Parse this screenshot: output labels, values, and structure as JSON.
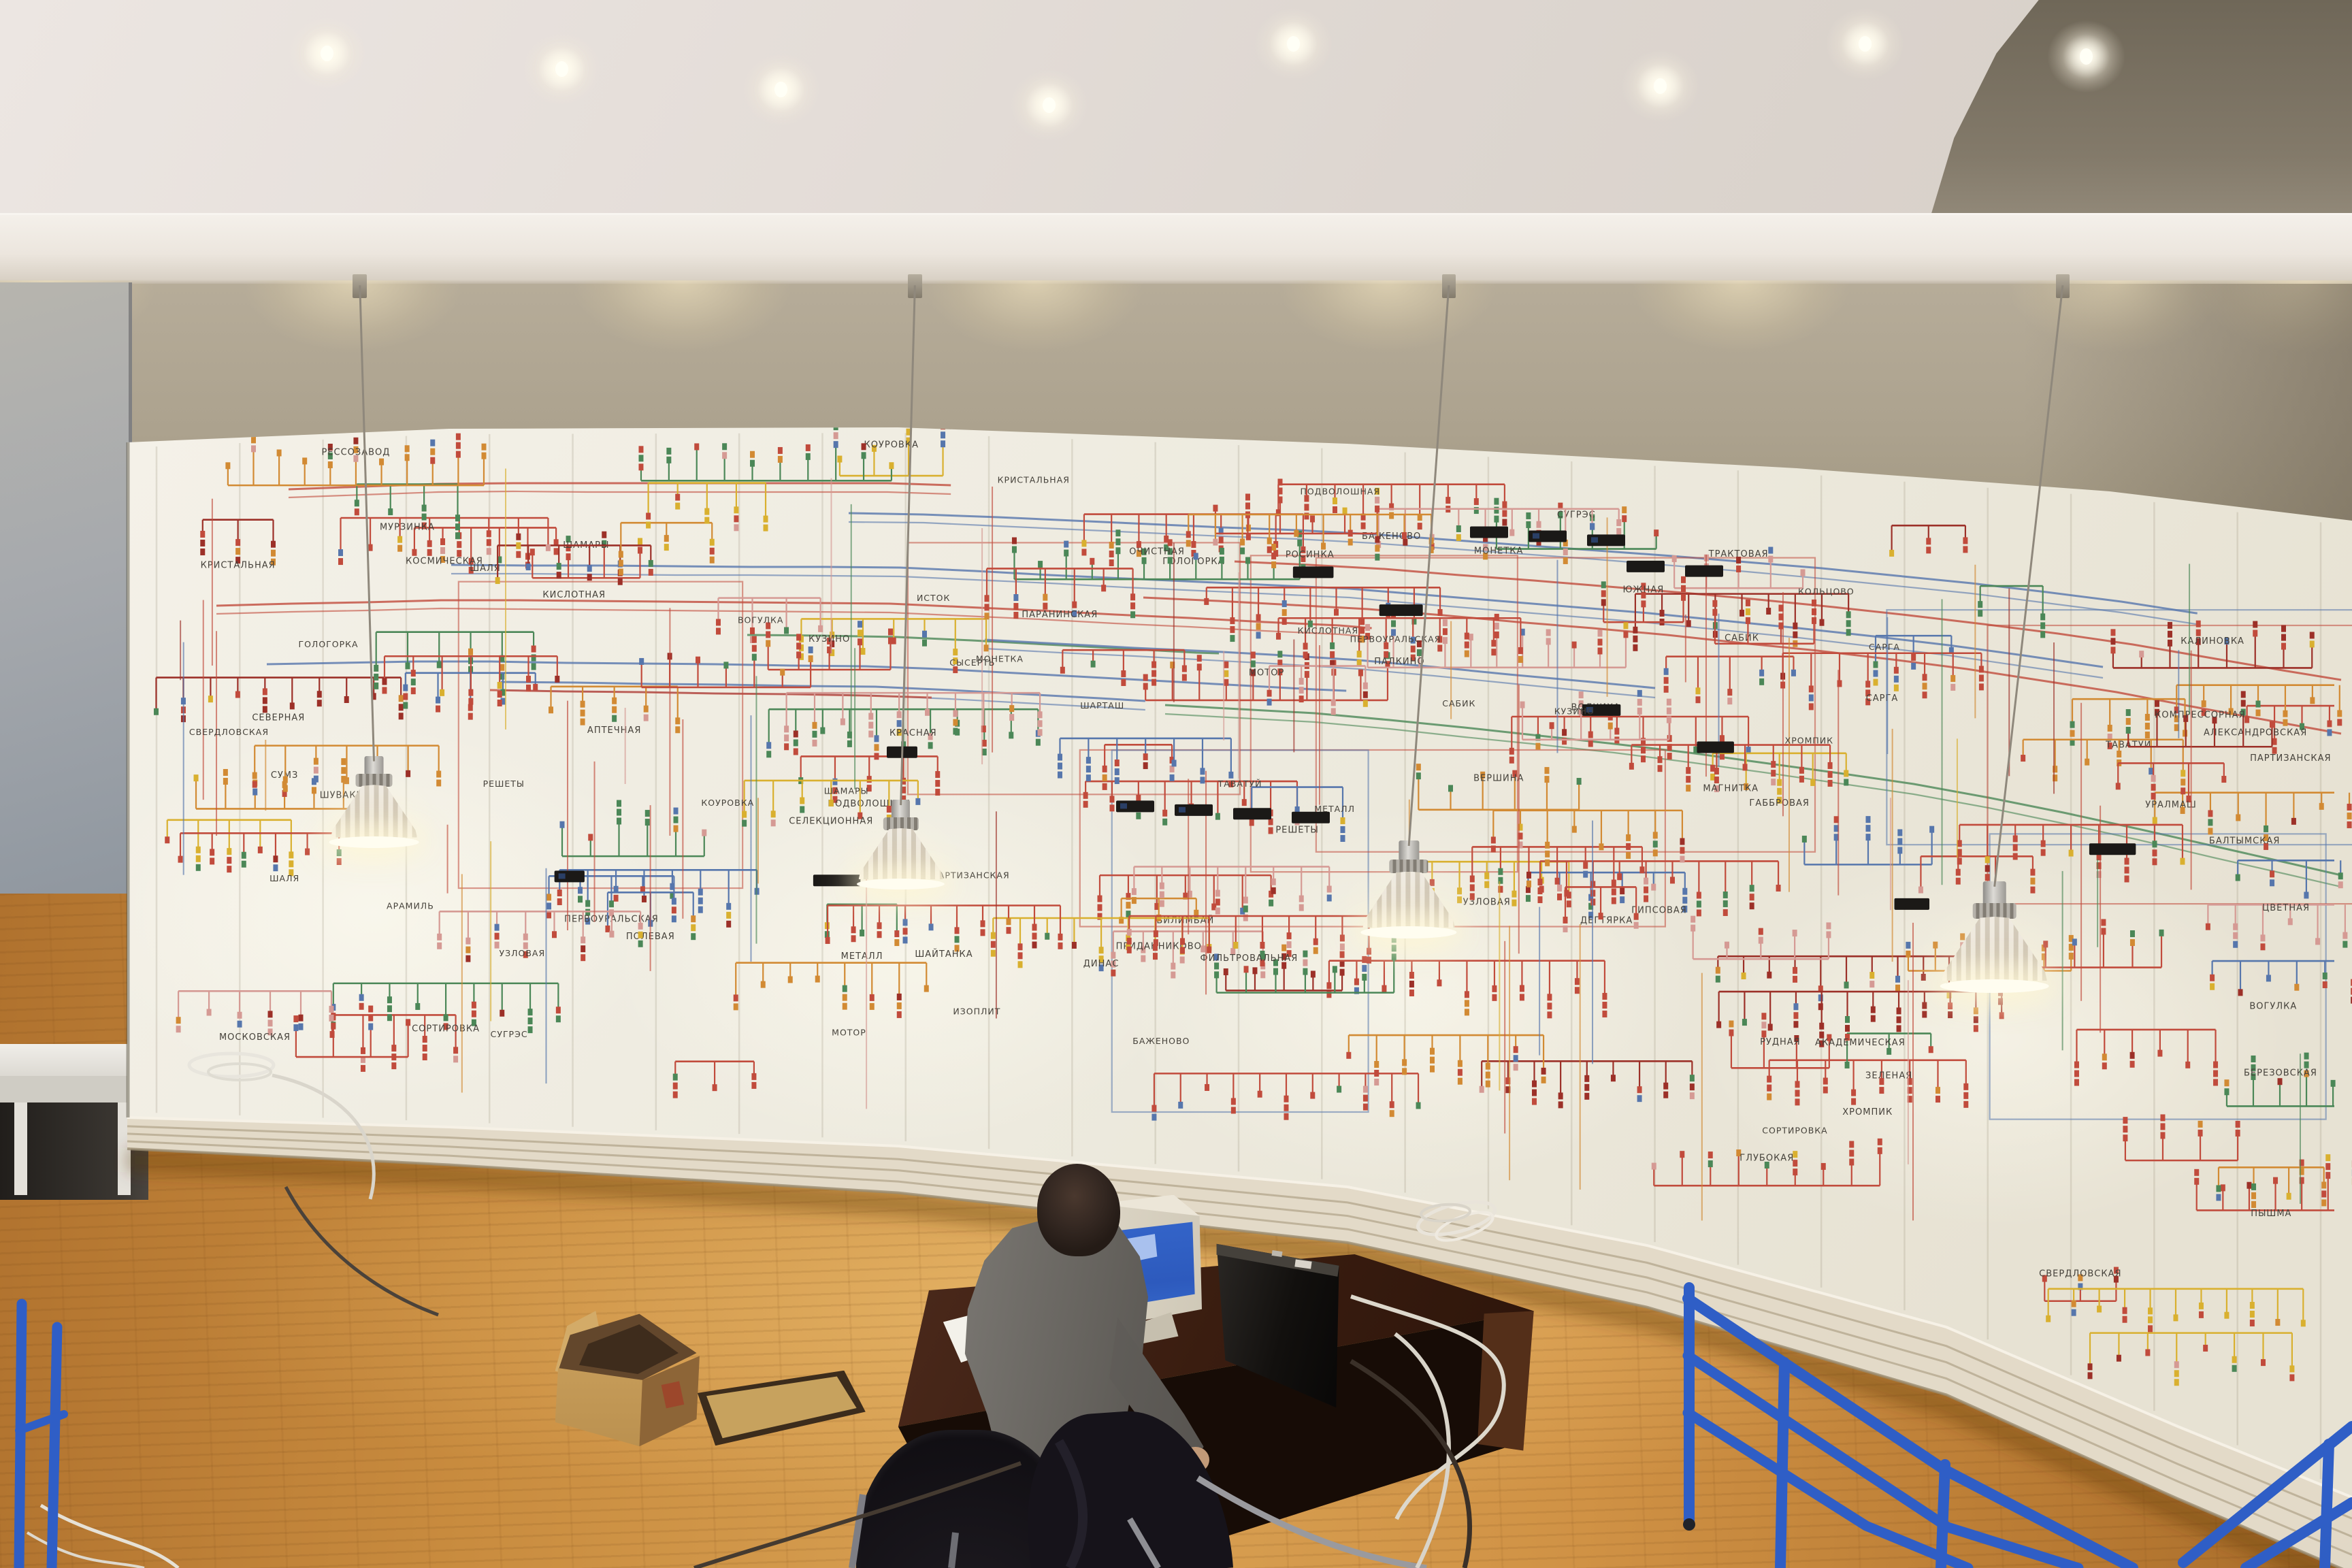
{
  "scene": {
    "title": "power-grid dispatch control room with curved mimic board",
    "colors": {
      "ceiling": "#e8e2dd",
      "fascia": "#efe9e2",
      "upper_wall": "#aca28e",
      "board_face": "#f0ede2",
      "trim": "#e2d8c5",
      "floor": "#d09245",
      "left_wall": "#9aa0a8",
      "desk": "#3a1d10",
      "suit": "#66635e",
      "monitor_screen": "#2d5abd",
      "tower": "#12100e",
      "cardboard": "#c9a05e"
    }
  },
  "board": {
    "palette": {
      "red": "#c14b3c",
      "darkred": "#9c3028",
      "orange": "#d28a33",
      "yellow": "#d9b02f",
      "green": "#4b8757",
      "teal": "#6fa08a",
      "blue": "#5676ac",
      "pink": "#d59a94",
      "label": "#45413a",
      "module": "#1b1917",
      "seam": "rgba(150,140,118,0.22)"
    },
    "seed": 20259,
    "density": {
      "panel_seams": 27,
      "long_buses": 12,
      "section_outlines": 9,
      "clusters": 122,
      "vertical_links": 70,
      "black_modules": 9,
      "extra_labels": 30
    },
    "module_rows": [
      [
        1640,
        0.5,
        4
      ],
      [
        2160,
        0.1,
        3
      ],
      [
        2390,
        0.13,
        2
      ]
    ],
    "station_names": [
      "ШАМАРЫ",
      "ВОГУЛКА",
      "ШАЛЯ",
      "САРГА",
      "САБИК",
      "КУЗИНО",
      "КОУРОВКА",
      "ПОДВОЛОШНАЯ",
      "ПАРТИЗАНСКАЯ",
      "КИСЛОТНАЯ",
      "МЕТАЛЛ",
      "ХРОМПИК",
      "ГОЛОГОРКА",
      "РЕШЕТЫ",
      "СУГРЭС",
      "КРИСТАЛЬНАЯ",
      "ПЕРВОУРАЛЬСКАЯ",
      "СВЕРДЛОВСКАЯ",
      "МОТОР",
      "ТАВАТУЙ",
      "СОРТИРОВКА",
      "УЗЛОВАЯ",
      "БАЖЕНОВО",
      "МОНЕТКА",
      "ЗЕЛЕНАЯ",
      "КРАСНАЯ",
      "БАЛТЫМСКАЯ",
      "СЕВЕРНАЯ",
      "КОСМИЧЕСКАЯ",
      "МУРЗИНКА",
      "РЕССОЗАВОД",
      "ГЛУБОКАЯ",
      "ПОЛЕВАЯ",
      "КАЛИНОВКА",
      "ОЧИСТНАЯ",
      "БИЛИМБАЙ",
      "ПАРАНИНСКАЯ",
      "ГАББРОВАЯ",
      "ДЕГТЯРКА",
      "РУДНАЯ",
      "АЛЕКСАНДРОВСКАЯ",
      "СЕЛЕКЦИОННАЯ",
      "ТРАКТОВАЯ",
      "ГИПСОВАЯ",
      "ПРИДАННИКОВО",
      "ЮЖНАЯ",
      "ЦВЕТНАЯ",
      "РОСИНКА",
      "КОМПРЕССОРНАЯ",
      "СУМЗ",
      "ДИНАС",
      "ВОЛЧИХА",
      "ШАЙТАНКА",
      "МАГНИТКА",
      "ВЕРШИНА",
      "АПТЕЧНАЯ",
      "ФИЛЬТРОВАЛЬНАЯ",
      "АКАДЕМИЧЕСКАЯ",
      "МОСКОВСКАЯ",
      "ПАЛКИНО",
      "ШУВАКИШ",
      "УРАЛМАШ",
      "ПЫШМА",
      "БЕРЕЗОВСКАЯ",
      "ИЗОПЛИТ",
      "ШАРТАШ",
      "ИСТОК",
      "КОЛЬЦОВО",
      "АРАМИЛЬ",
      "СЫСЕРТЬ"
    ]
  },
  "ceiling_lights": [
    [
      13.9,
      1.7
    ],
    [
      23.9,
      2.7
    ],
    [
      33.2,
      4.0
    ],
    [
      44.6,
      5.0
    ],
    [
      55.0,
      1.1
    ],
    [
      70.6,
      3.8
    ],
    [
      79.3,
      1.1
    ],
    [
      88.7,
      1.9
    ]
  ],
  "wall_washes": [
    2,
    15,
    29,
    44,
    59,
    74,
    90,
    98
  ],
  "lamp_mounts": [
    15.3,
    38.9,
    61.6,
    87.7
  ],
  "lamps": [
    {
      "x": 15.9,
      "top": 48.2,
      "scale": 0.92
    },
    {
      "x": 38.3,
      "top": 51.0,
      "scale": 0.9
    },
    {
      "x": 59.9,
      "top": 53.6,
      "scale": 0.98
    },
    {
      "x": 84.8,
      "top": 56.2,
      "scale": 1.12
    }
  ],
  "railing": {
    "color": "#2f5ec6",
    "color_dark": "#1e3f8a"
  }
}
